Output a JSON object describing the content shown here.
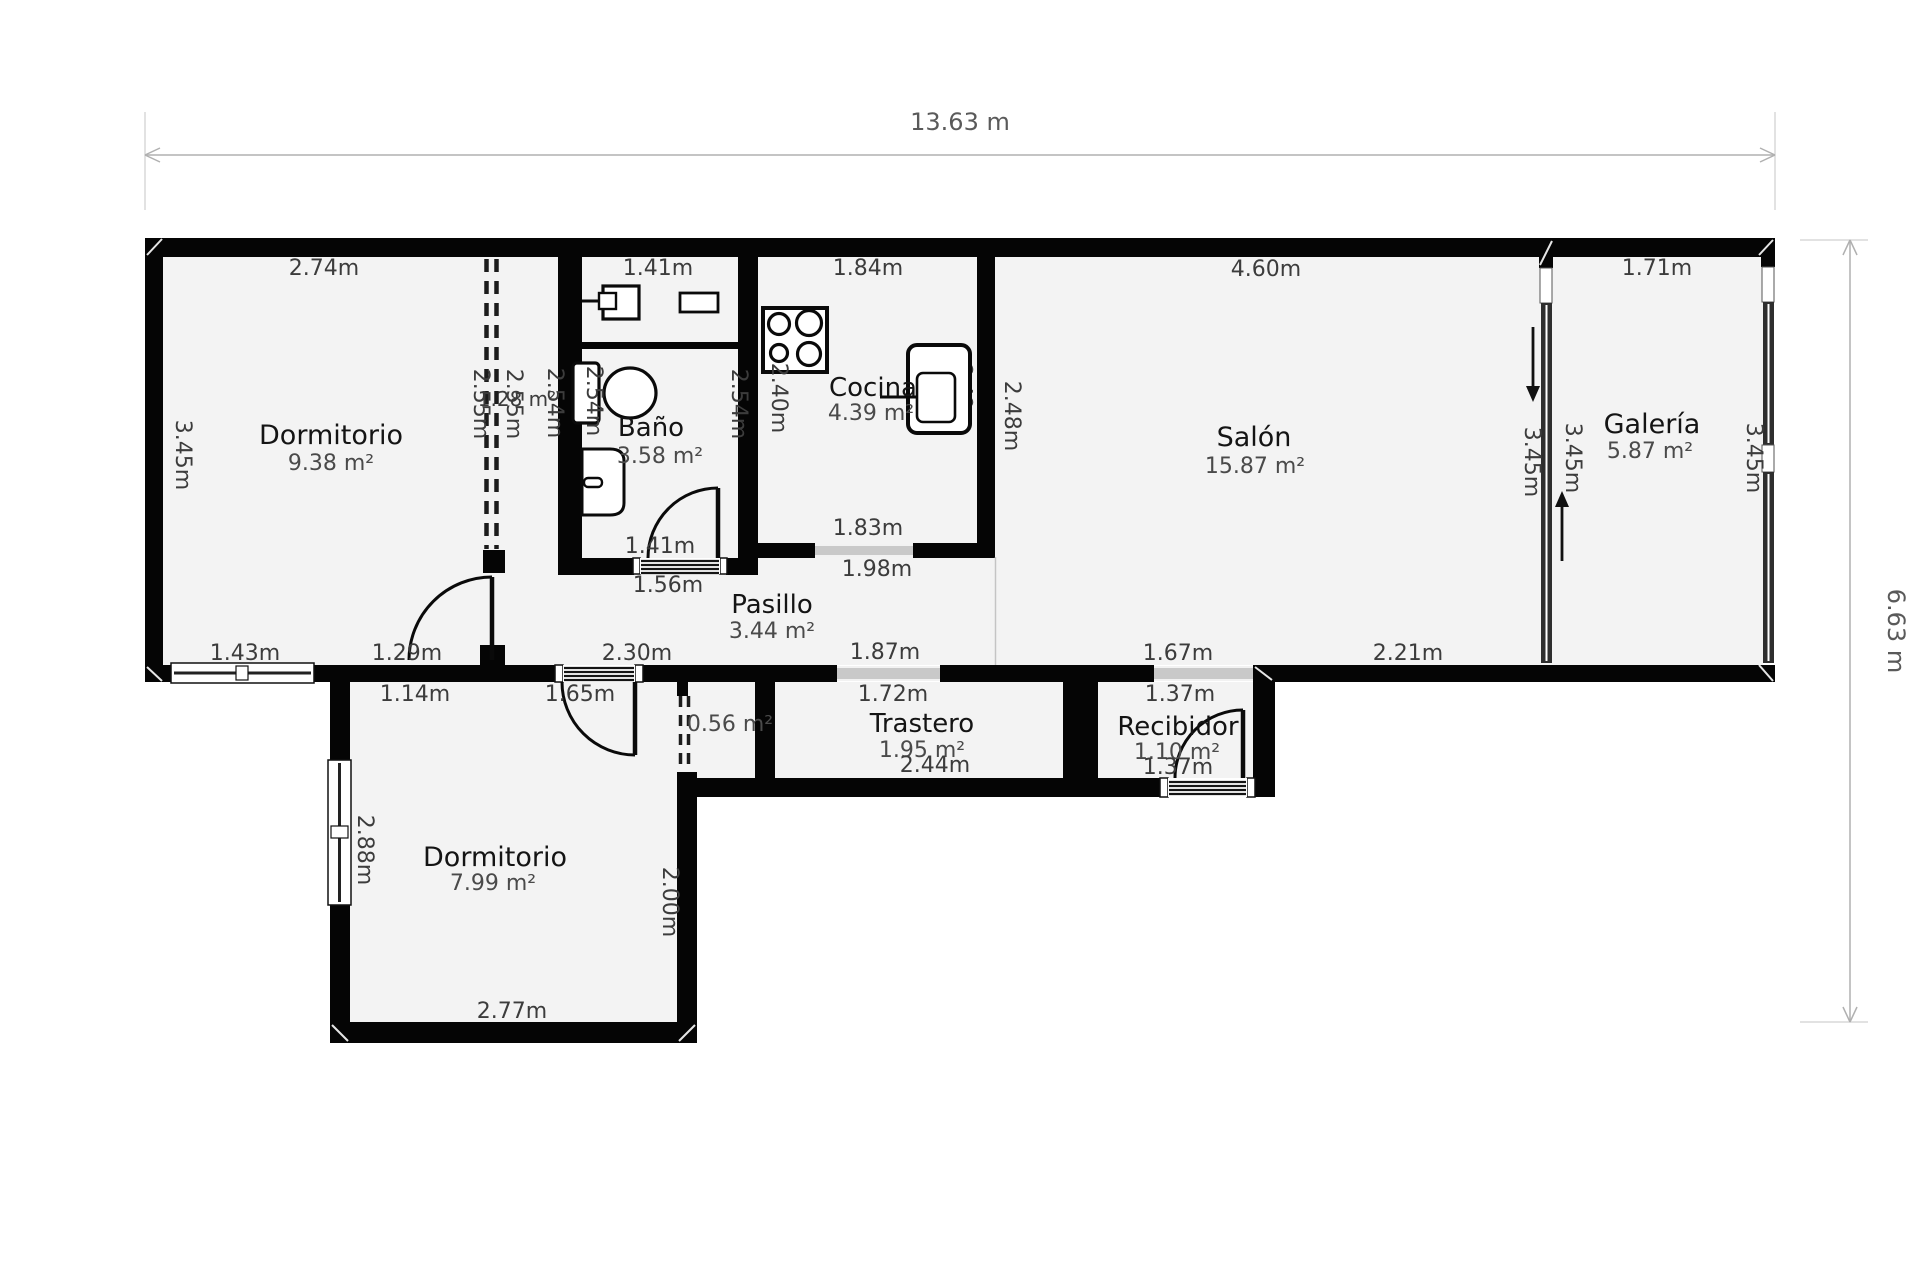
{
  "floorplan": {
    "overall": {
      "width_label": "13.63 m",
      "height_label": "6.63 m"
    },
    "rooms": {
      "dormitorio1": {
        "name": "Dormitorio",
        "area": "9.38 m²"
      },
      "bano": {
        "name": "Baño",
        "area": "3.58 m²"
      },
      "cocina": {
        "name": "Cocina",
        "area": "4.39 m²"
      },
      "salon": {
        "name": "Salón",
        "area": "15.87 m²"
      },
      "galeria": {
        "name": "Galería",
        "area": "5.87 m²"
      },
      "pasillo": {
        "name": "Pasillo",
        "area": "3.44 m²"
      },
      "trastero": {
        "name": "Trastero",
        "area": "1.95 m²",
        "width": "2.44m"
      },
      "recibidor": {
        "name": "Recibidor",
        "area": "1.10 m²",
        "width": "1.37m"
      },
      "dormitorio2": {
        "name": "Dormitorio",
        "area": "7.99 m²"
      },
      "armario_pasillo": {
        "area": "0.56 m²"
      },
      "armario_dormitorio": {
        "area": "1.28 m²"
      }
    },
    "dimensions": {
      "dorm1_top": "2.74m",
      "dorm1_left": "3.45m",
      "dorm1_bottom": "1.43m",
      "dorm1_door": "1.29m",
      "ward_left": "2.55m",
      "ward_inner": "2.55m",
      "ward_right": "2.54m",
      "bath_top": "1.41m",
      "bath_left": "2.54m",
      "bath_right": "2.54m",
      "bath_bottom": "1.41m",
      "bath_door": "1.56m",
      "kit_top": "1.84m",
      "kit_left": "2.40m",
      "kit_right": "2.48m",
      "kit_bottom": "1.83m",
      "kit_open": "1.98m",
      "salon_top": "4.60m",
      "salon_left": "2.48m",
      "salon_right": "3.45m",
      "gal_top": "1.71m",
      "gal_left": "3.45m",
      "gal_right": "3.45m",
      "pas_bottom_l": "2.30m",
      "pas_bottom_r": "1.87m",
      "salon_bot_l": "1.67m",
      "salon_bot_r": "2.21m",
      "d2_top": "1.14m",
      "d2_door": "1.65m",
      "d2_left": "2.88m",
      "d2_right": "2.00m",
      "d2_bottom": "2.77m",
      "tras_top": "1.72m",
      "rec_top": "1.37m"
    },
    "colors": {
      "wall": "#050505",
      "floor": "#f3f3f3",
      "opening": "#c9c9c9",
      "dim_text": "#3c3c3c"
    }
  }
}
